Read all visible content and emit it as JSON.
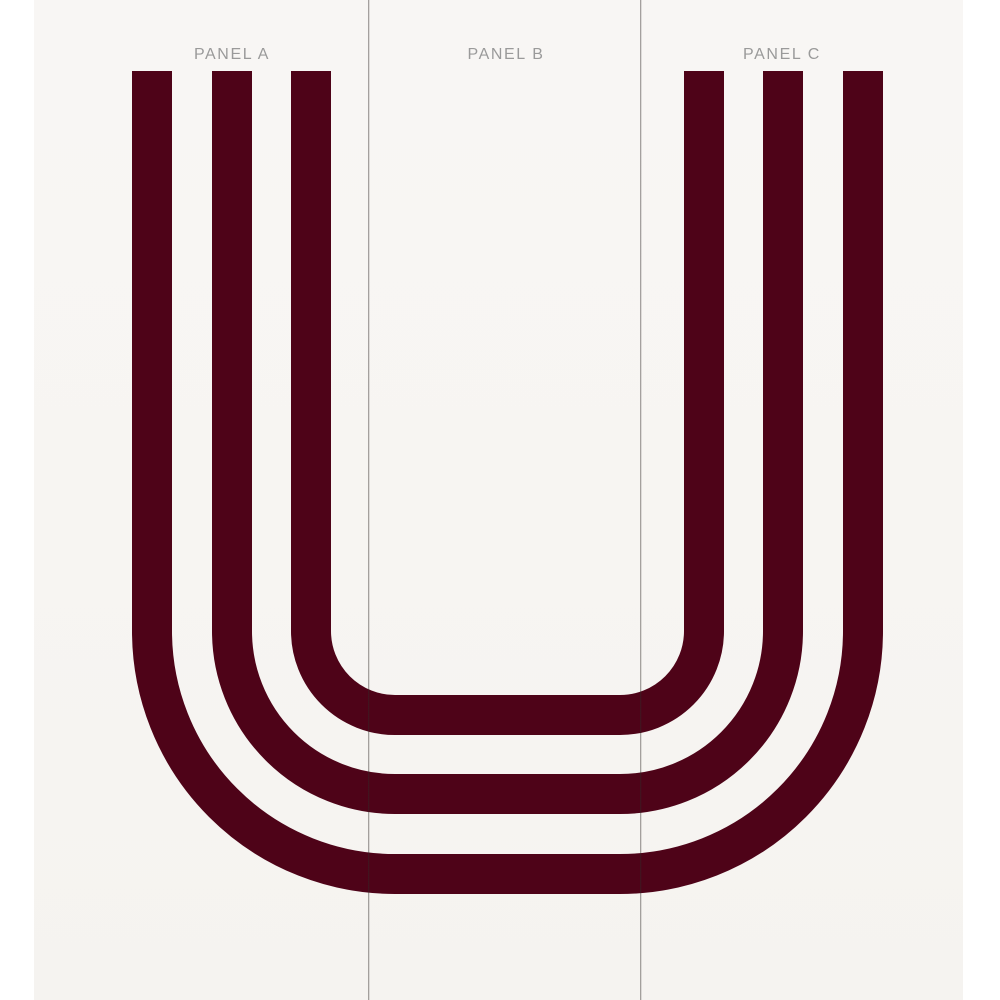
{
  "artwork": {
    "depicted_letter": "U",
    "stripe_count": 3,
    "stripe_color": "#4e0318",
    "canvas_color": "#f7f5f2",
    "margin_color": "#ffffff",
    "divider_color": "#a5a2a0",
    "label_color": "#9a9a9a",
    "panels": [
      {
        "label": "PANEL A"
      },
      {
        "label": "PANEL B"
      },
      {
        "label": "PANEL C"
      }
    ]
  }
}
